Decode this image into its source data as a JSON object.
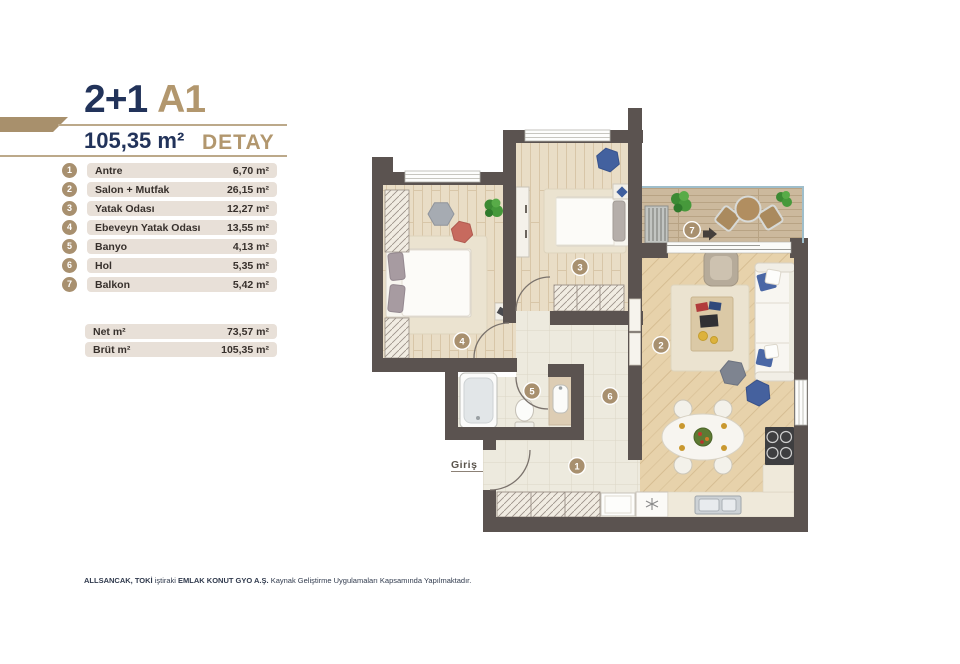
{
  "header": {
    "unit_type": "2+1",
    "block": "A1",
    "area": "105,35 m²",
    "detail": "DETAY"
  },
  "legend": {
    "rooms": [
      {
        "no": "1",
        "name": "Antre",
        "area": "6,70 m²"
      },
      {
        "no": "2",
        "name": "Salon + Mutfak",
        "area": "26,15 m²"
      },
      {
        "no": "3",
        "name": "Yatak Odası",
        "area": "12,27 m²"
      },
      {
        "no": "4",
        "name": "Ebeveyn Yatak Odası",
        "area": "13,55 m²"
      },
      {
        "no": "5",
        "name": "Banyo",
        "area": "4,13 m²"
      },
      {
        "no": "6",
        "name": "Hol",
        "area": "5,35 m²"
      },
      {
        "no": "7",
        "name": "Balkon",
        "area": "5,42 m²"
      }
    ],
    "totals": [
      {
        "label": "Net m²",
        "value": "73,57 m²"
      },
      {
        "label": "Brüt m²",
        "value": "105,35 m²"
      }
    ]
  },
  "plan": {
    "entrance_label": "Giriş"
  },
  "footer": {
    "seg1_bold": "ALLSANCAK, TOKİ",
    "seg2": " iştiraki ",
    "seg3_bold": "EMLAK KONUT GYO A.Ş.",
    "seg4": " Kaynak Geliştirme Uygulamaları Kapsamında Yapılmaktadır."
  },
  "colors": {
    "navy": "#22335a",
    "gold": "#b2976e",
    "row_bg": "#e8e0d8",
    "badge": "#a8906f",
    "wall": "#5b5350"
  }
}
